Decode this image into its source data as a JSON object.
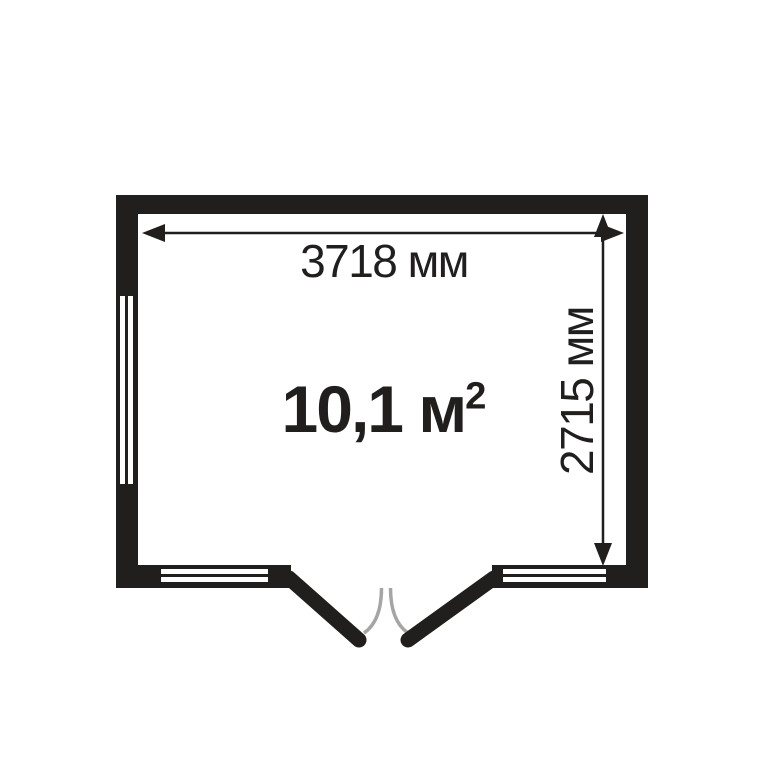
{
  "floorplan": {
    "width_label": "3718 мм",
    "height_label": "2715 мм",
    "area_label": "10,1 м",
    "area_superscript": "2",
    "width_mm": 3718,
    "height_mm": 2715,
    "area_sq_m": "10,1",
    "colors": {
      "wall": "#211e1e",
      "background": "#ffffff",
      "swing_arc": "#a5a5a5",
      "text": "#211e1e"
    }
  }
}
